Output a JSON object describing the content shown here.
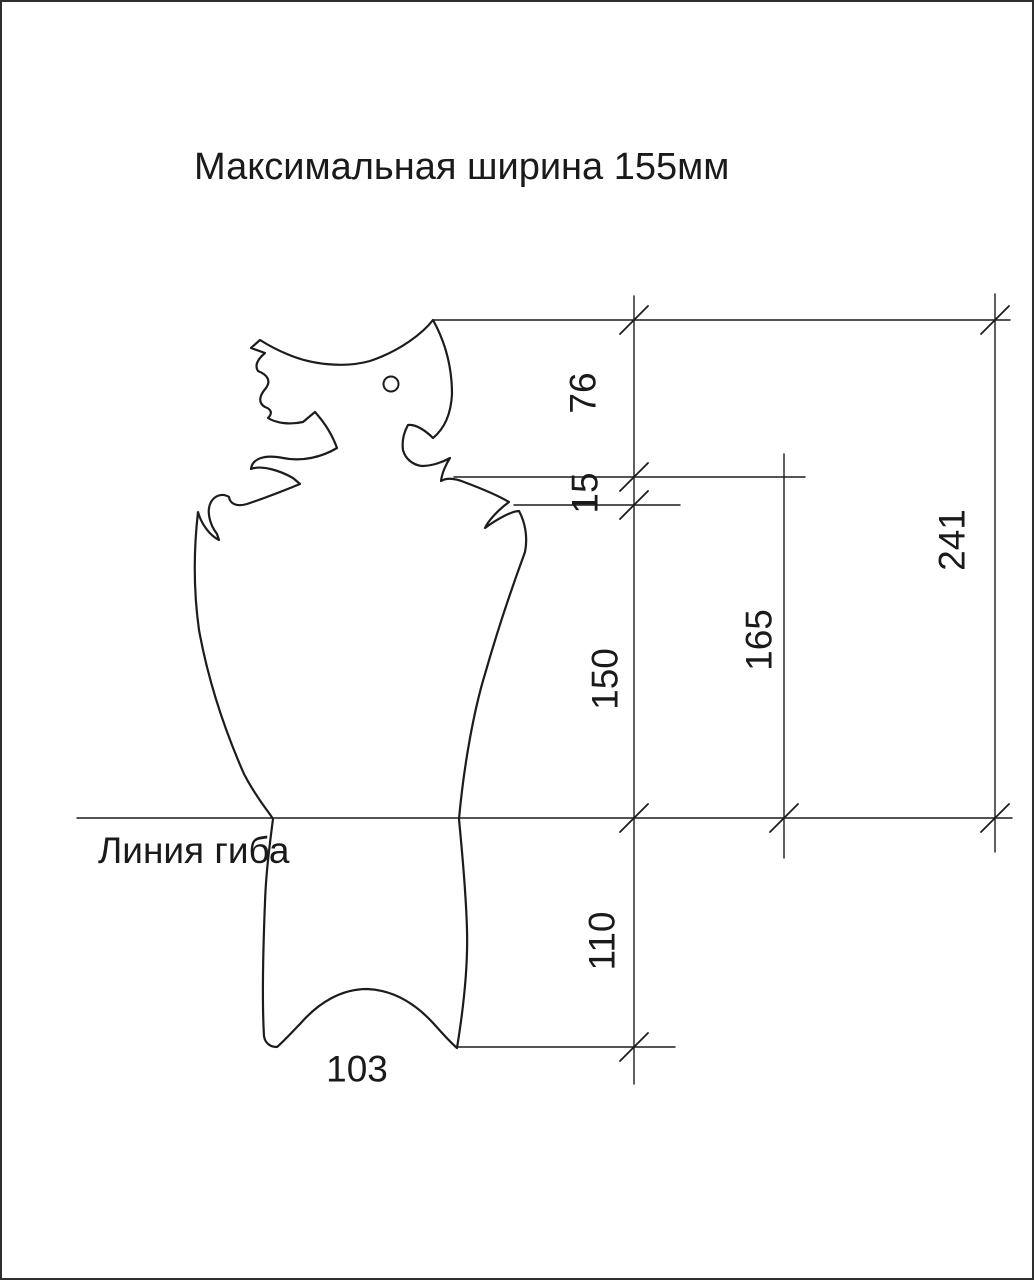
{
  "title": "Максимальная ширина 155мм",
  "bend_line": {
    "label": "Линия гиба"
  },
  "dimensions": {
    "head_height": "76",
    "neck_offset": "15",
    "body_height": "150",
    "lower_height": "110",
    "neck_to_bend": "165",
    "top_to_bend": "241",
    "bottom_width": "103"
  },
  "colors": {
    "background": "#ffffff",
    "line": "#1c1c1c",
    "page_border": "#2e2e2e"
  }
}
